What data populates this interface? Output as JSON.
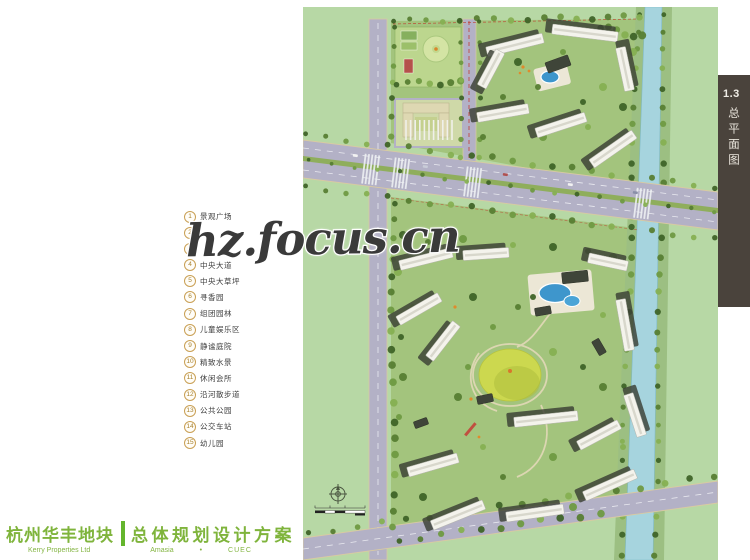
{
  "watermark": {
    "text": "hz.focus.cn"
  },
  "legend": {
    "items": [
      {
        "num": "1",
        "label": "景观广场"
      },
      {
        "num": "2",
        "label": ""
      },
      {
        "num": "3",
        "label": ""
      },
      {
        "num": "4",
        "label": "中央大道"
      },
      {
        "num": "5",
        "label": "中央大草坪"
      },
      {
        "num": "6",
        "label": "寻香园"
      },
      {
        "num": "7",
        "label": "组团园林"
      },
      {
        "num": "8",
        "label": "儿童娱乐区"
      },
      {
        "num": "9",
        "label": "静谧庭院"
      },
      {
        "num": "10",
        "label": "精致水景"
      },
      {
        "num": "11",
        "label": "休闲会所"
      },
      {
        "num": "12",
        "label": "沿河散步道"
      },
      {
        "num": "13",
        "label": "公共公园"
      },
      {
        "num": "14",
        "label": "公交车站"
      },
      {
        "num": "15",
        "label": "幼儿园"
      }
    ]
  },
  "sidebar": {
    "section_number": "1.3",
    "section_title": "总平面图"
  },
  "footer": {
    "project_name": "杭州华丰地块",
    "plan_title": "总体规划设计方案",
    "developer": "Kerry Properties Ltd",
    "partner1": "Amasia",
    "separator": "•",
    "partner2": "CUEC"
  },
  "colors": {
    "title_green": "#7fb43c",
    "bar_green": "#64b52d",
    "legend_circle": "#c9a055",
    "sidebar_bg": "#4a433c",
    "watermark": "#3a3a3a",
    "grass": "#b7d8a5",
    "road": "#b3b1c6",
    "river": "#a6d4de",
    "pool_blue": "#3e96cc",
    "lawn_yellow": "#ccd84f"
  }
}
